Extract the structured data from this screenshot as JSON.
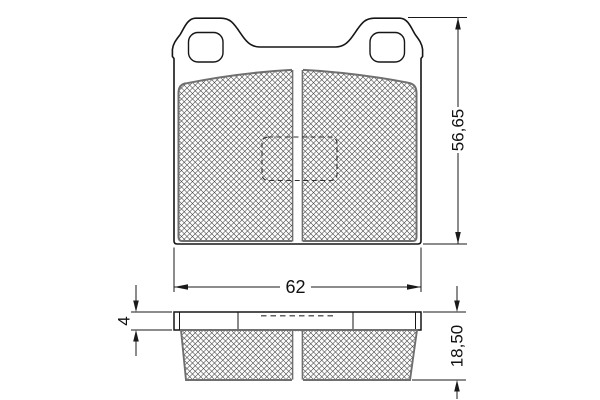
{
  "dimensions": {
    "overall_height": "56,65",
    "overall_width": "62",
    "backplate_thickness": "4",
    "total_thickness": "18,50"
  }
}
